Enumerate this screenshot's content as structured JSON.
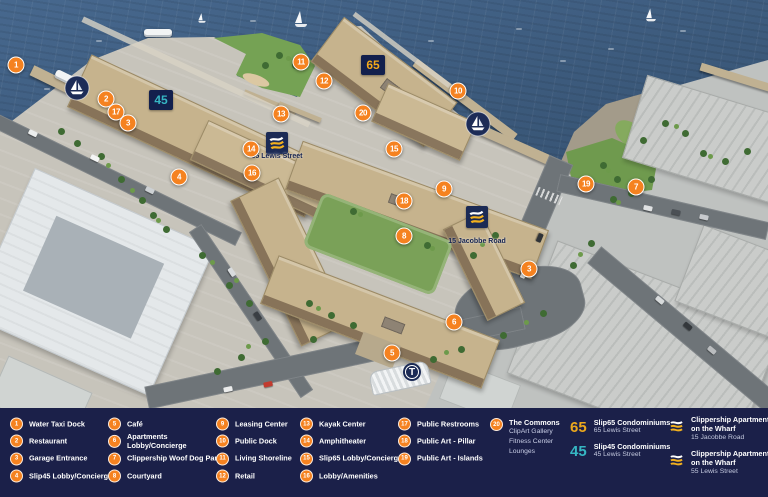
{
  "legend": {
    "background": "#1b2049",
    "marker_color": "#f58220",
    "columns": [
      {
        "items": [
          {
            "num": "1",
            "label": "Water Taxi Dock"
          },
          {
            "num": "2",
            "label": "Restaurant"
          },
          {
            "num": "3",
            "label": "Garage Entrance"
          },
          {
            "num": "4",
            "label": "Slip45 Lobby/Concierge"
          }
        ]
      },
      {
        "items": [
          {
            "num": "5",
            "label": "Café"
          },
          {
            "num": "6",
            "label": "Apartments",
            "label2": "Lobby/Concierge"
          },
          {
            "num": "7",
            "label": "Clippership Woof Dog Park"
          },
          {
            "num": "8",
            "label": "Courtyard"
          }
        ]
      },
      {
        "items": [
          {
            "num": "9",
            "label": "Leasing Center"
          },
          {
            "num": "10",
            "label": "Public Dock"
          },
          {
            "num": "11",
            "label": "Living Shoreline"
          },
          {
            "num": "12",
            "label": "Retail"
          }
        ]
      },
      {
        "items": [
          {
            "num": "13",
            "label": "Kayak Center"
          },
          {
            "num": "14",
            "label": "Amphitheater"
          },
          {
            "num": "15",
            "label": "Slip65 Lobby/Concierge"
          },
          {
            "num": "16",
            "label": "Lobby/Amenities"
          }
        ]
      },
      {
        "items": [
          {
            "num": "17",
            "label": "Public Restrooms"
          },
          {
            "num": "18",
            "label": "Public Art - Pillar"
          },
          {
            "num": "19",
            "label": "Public Art - Islands"
          }
        ]
      },
      {
        "items": [
          {
            "num": "20",
            "label": "The Commons",
            "sub": [
              "ClipArt Gallery",
              "Fitness Center",
              "Lounges"
            ]
          }
        ]
      }
    ],
    "buildings": [
      {
        "code": "65",
        "code_color": "#eca81d",
        "name": "Slip65 Condominiums",
        "address": "65 Lewis Street"
      },
      {
        "code": "45",
        "code_color": "#36b6c3",
        "name": "Slip45 Condominiums",
        "address": "45 Lewis Street"
      }
    ],
    "flag_entries": [
      {
        "name_line1": "Clippership Apartments",
        "name_line2": "on the Wharf",
        "address": "15 Jacobbe Road"
      },
      {
        "name_line1": "Clippership Apartments",
        "name_line2": "on the Wharf",
        "address": "55 Lewis Street"
      }
    ]
  },
  "map": {
    "water_color": "#3c5a7c",
    "navy": "#1b2a55",
    "roof_labels": [
      {
        "text": "45",
        "color": "#36b6c3",
        "x": 149,
        "y": 90
      },
      {
        "text": "65",
        "color": "#f3a81b",
        "x": 361,
        "y": 55
      }
    ],
    "site_labels": [
      {
        "text": "55 Lewis Street",
        "x": 277,
        "y": 157
      },
      {
        "text": "15 Jacobbe Road",
        "x": 477,
        "y": 242
      }
    ],
    "badges": {
      "t_label": "T"
    },
    "markers": [
      {
        "num": "1",
        "x": 16,
        "y": 65
      },
      {
        "num": "2",
        "x": 106,
        "y": 99
      },
      {
        "num": "17",
        "x": 116,
        "y": 112
      },
      {
        "num": "3",
        "x": 128,
        "y": 123
      },
      {
        "num": "4",
        "x": 179,
        "y": 177
      },
      {
        "num": "14",
        "x": 251,
        "y": 149
      },
      {
        "num": "16",
        "x": 252,
        "y": 173
      },
      {
        "num": "13",
        "x": 281,
        "y": 114
      },
      {
        "num": "11",
        "x": 301,
        "y": 62
      },
      {
        "num": "12",
        "x": 324,
        "y": 81
      },
      {
        "num": "20",
        "x": 363,
        "y": 113
      },
      {
        "num": "15",
        "x": 394,
        "y": 149
      },
      {
        "num": "10",
        "x": 458,
        "y": 91
      },
      {
        "num": "9",
        "x": 444,
        "y": 189
      },
      {
        "num": "18",
        "x": 404,
        "y": 201
      },
      {
        "num": "8",
        "x": 404,
        "y": 236
      },
      {
        "num": "19",
        "x": 586,
        "y": 184
      },
      {
        "num": "7",
        "x": 636,
        "y": 187
      },
      {
        "num": "3",
        "x": 529,
        "y": 269
      },
      {
        "num": "6",
        "x": 454,
        "y": 322
      },
      {
        "num": "5",
        "x": 392,
        "y": 353
      }
    ]
  }
}
